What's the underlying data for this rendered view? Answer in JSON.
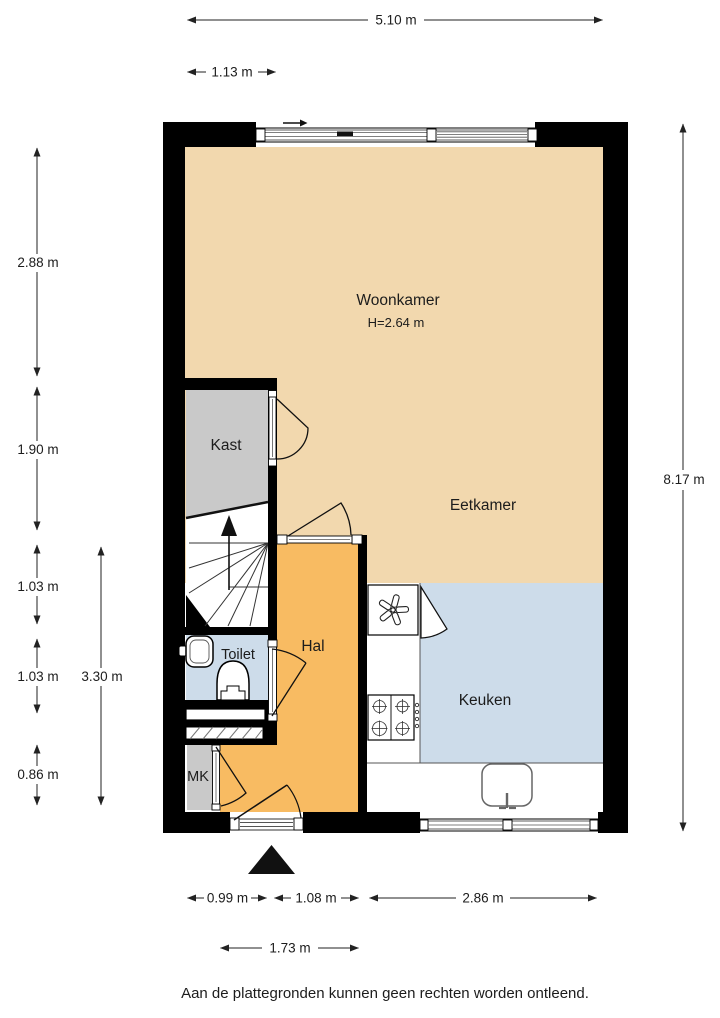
{
  "colors": {
    "living": "#f2d8ae",
    "hall": "#f8bb62",
    "wet": "#cddcea",
    "closet": "#c9c9c9",
    "wall": "#000000"
  },
  "rooms": {
    "woonkamer": {
      "label": "Woonkamer",
      "ceiling_height": "H=2.64 m"
    },
    "eetkamer": {
      "label": "Eetkamer"
    },
    "kast": {
      "label": "Kast"
    },
    "toilet": {
      "label": "Toilet"
    },
    "hal": {
      "label": "Hal"
    },
    "mk": {
      "label": "MK"
    },
    "keuken": {
      "label": "Keuken"
    }
  },
  "dims": {
    "total_width": "5.10 m",
    "kast_width": "1.13 m",
    "woonkamer_depth": "2.88 m",
    "kast_depth": "1.90 m",
    "stairs_depth": "1.03 m",
    "toilet_depth": "1.03 m",
    "mk_depth": "0.86 m",
    "hal_depth": "3.30 m",
    "total_depth": "8.17 m",
    "entry_width": "0.99 m",
    "hal_width": "1.08 m",
    "keuken_width": "2.86 m",
    "entry_hal_width": "1.73 m"
  },
  "footer": {
    "disclaimer": "Aan de plattegronden kunnen geen rechten worden ontleend."
  }
}
